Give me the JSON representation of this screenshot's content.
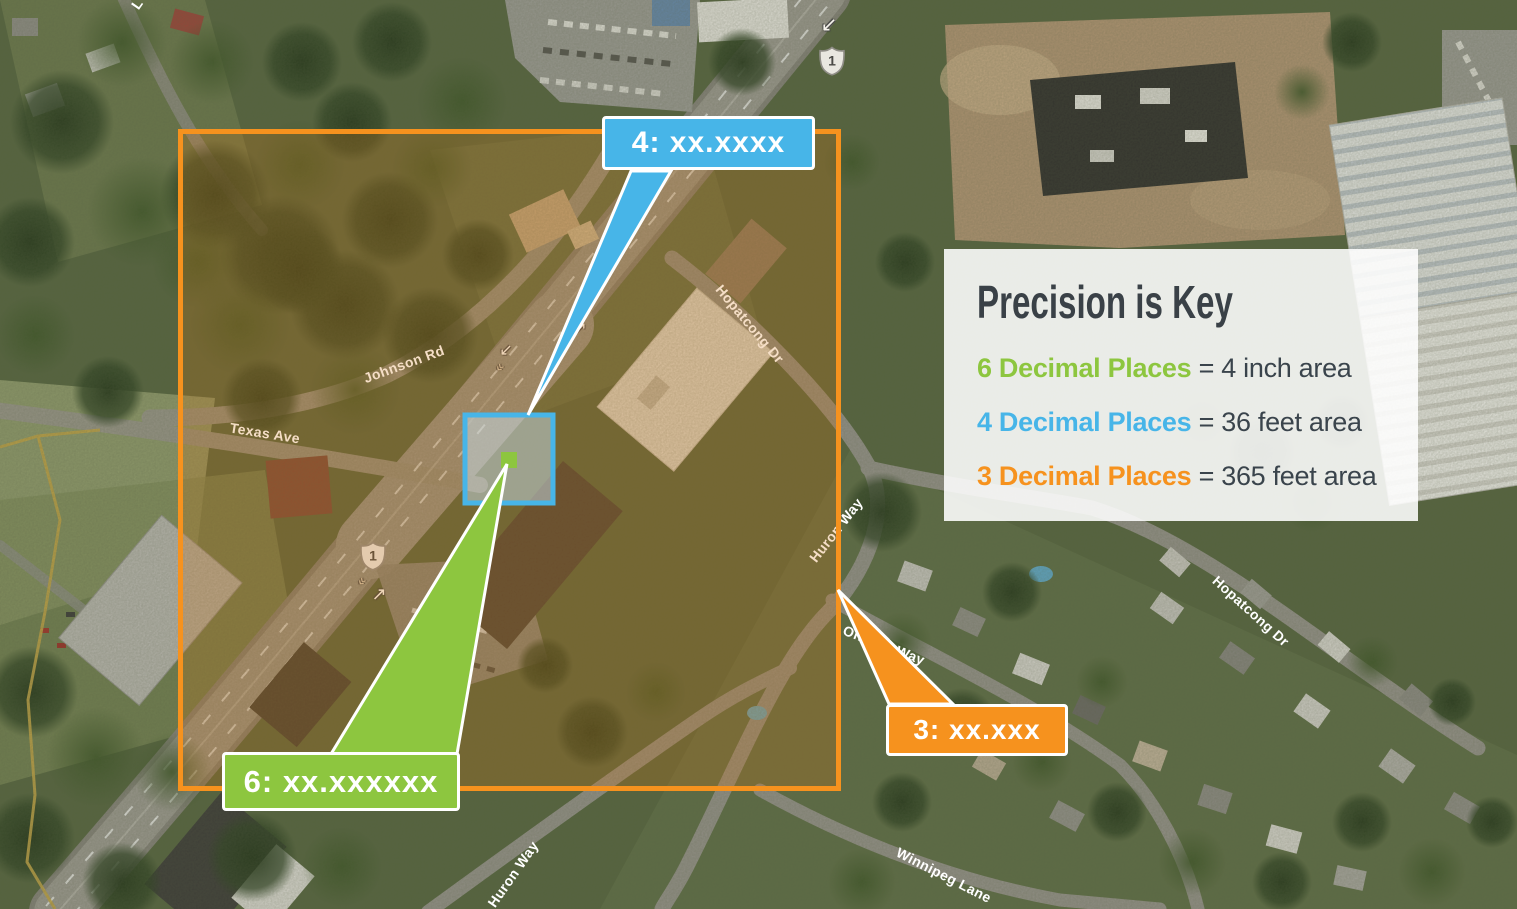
{
  "colors": {
    "green": "#8DC63F",
    "blue": "#47B5E8",
    "orange": "#F6921E",
    "dark_text": "#3A444C",
    "blue_fill": "rgba(200,222,234,0.5)"
  },
  "legend": {
    "title": "Precision is Key",
    "rows": [
      {
        "label": "6 Decimal Places",
        "value": "= 4 inch area",
        "color": "#8DC63F"
      },
      {
        "label": "4 Decimal Places",
        "value": "= 36 feet area",
        "color": "#47B5E8"
      },
      {
        "label": "3 Decimal Places",
        "value": "= 365 feet area",
        "color": "#F6921E"
      }
    ]
  },
  "callouts": {
    "six_decimals": {
      "label": "6: xx.xxxxxx"
    },
    "four_decimals": {
      "label": "4: xx.xxxx"
    },
    "three_decimals": {
      "label": "3: xx.xxx"
    }
  },
  "map": {
    "road_labels": [
      {
        "name": "johnson-rd",
        "label": "Johnson Rd"
      },
      {
        "name": "texas-ave",
        "label": "Texas Ave"
      },
      {
        "name": "hopatcong-dr-upper",
        "label": "Hopatcong Dr"
      },
      {
        "name": "huron-way-mid",
        "label": "Huron Way"
      },
      {
        "name": "ontario-way",
        "label": "Ontario Way"
      },
      {
        "name": "huron-way-lower",
        "label": "Huron Way"
      },
      {
        "name": "winnipeg-lane",
        "label": "Winnipeg Lane"
      },
      {
        "name": "hopatcong-dr-right",
        "label": "Hopatcong Dr"
      },
      {
        "name": "partial-street-label",
        "label": "L"
      }
    ],
    "route_shields": [
      {
        "label": "1"
      },
      {
        "label": "1"
      }
    ],
    "direction_arrows": [
      {
        "glyph": "↙"
      },
      {
        "glyph": "↗"
      },
      {
        "glyph": "↙"
      },
      {
        "glyph": "↗"
      },
      {
        "glyph": "«"
      },
      {
        "glyph": "«"
      }
    ]
  }
}
